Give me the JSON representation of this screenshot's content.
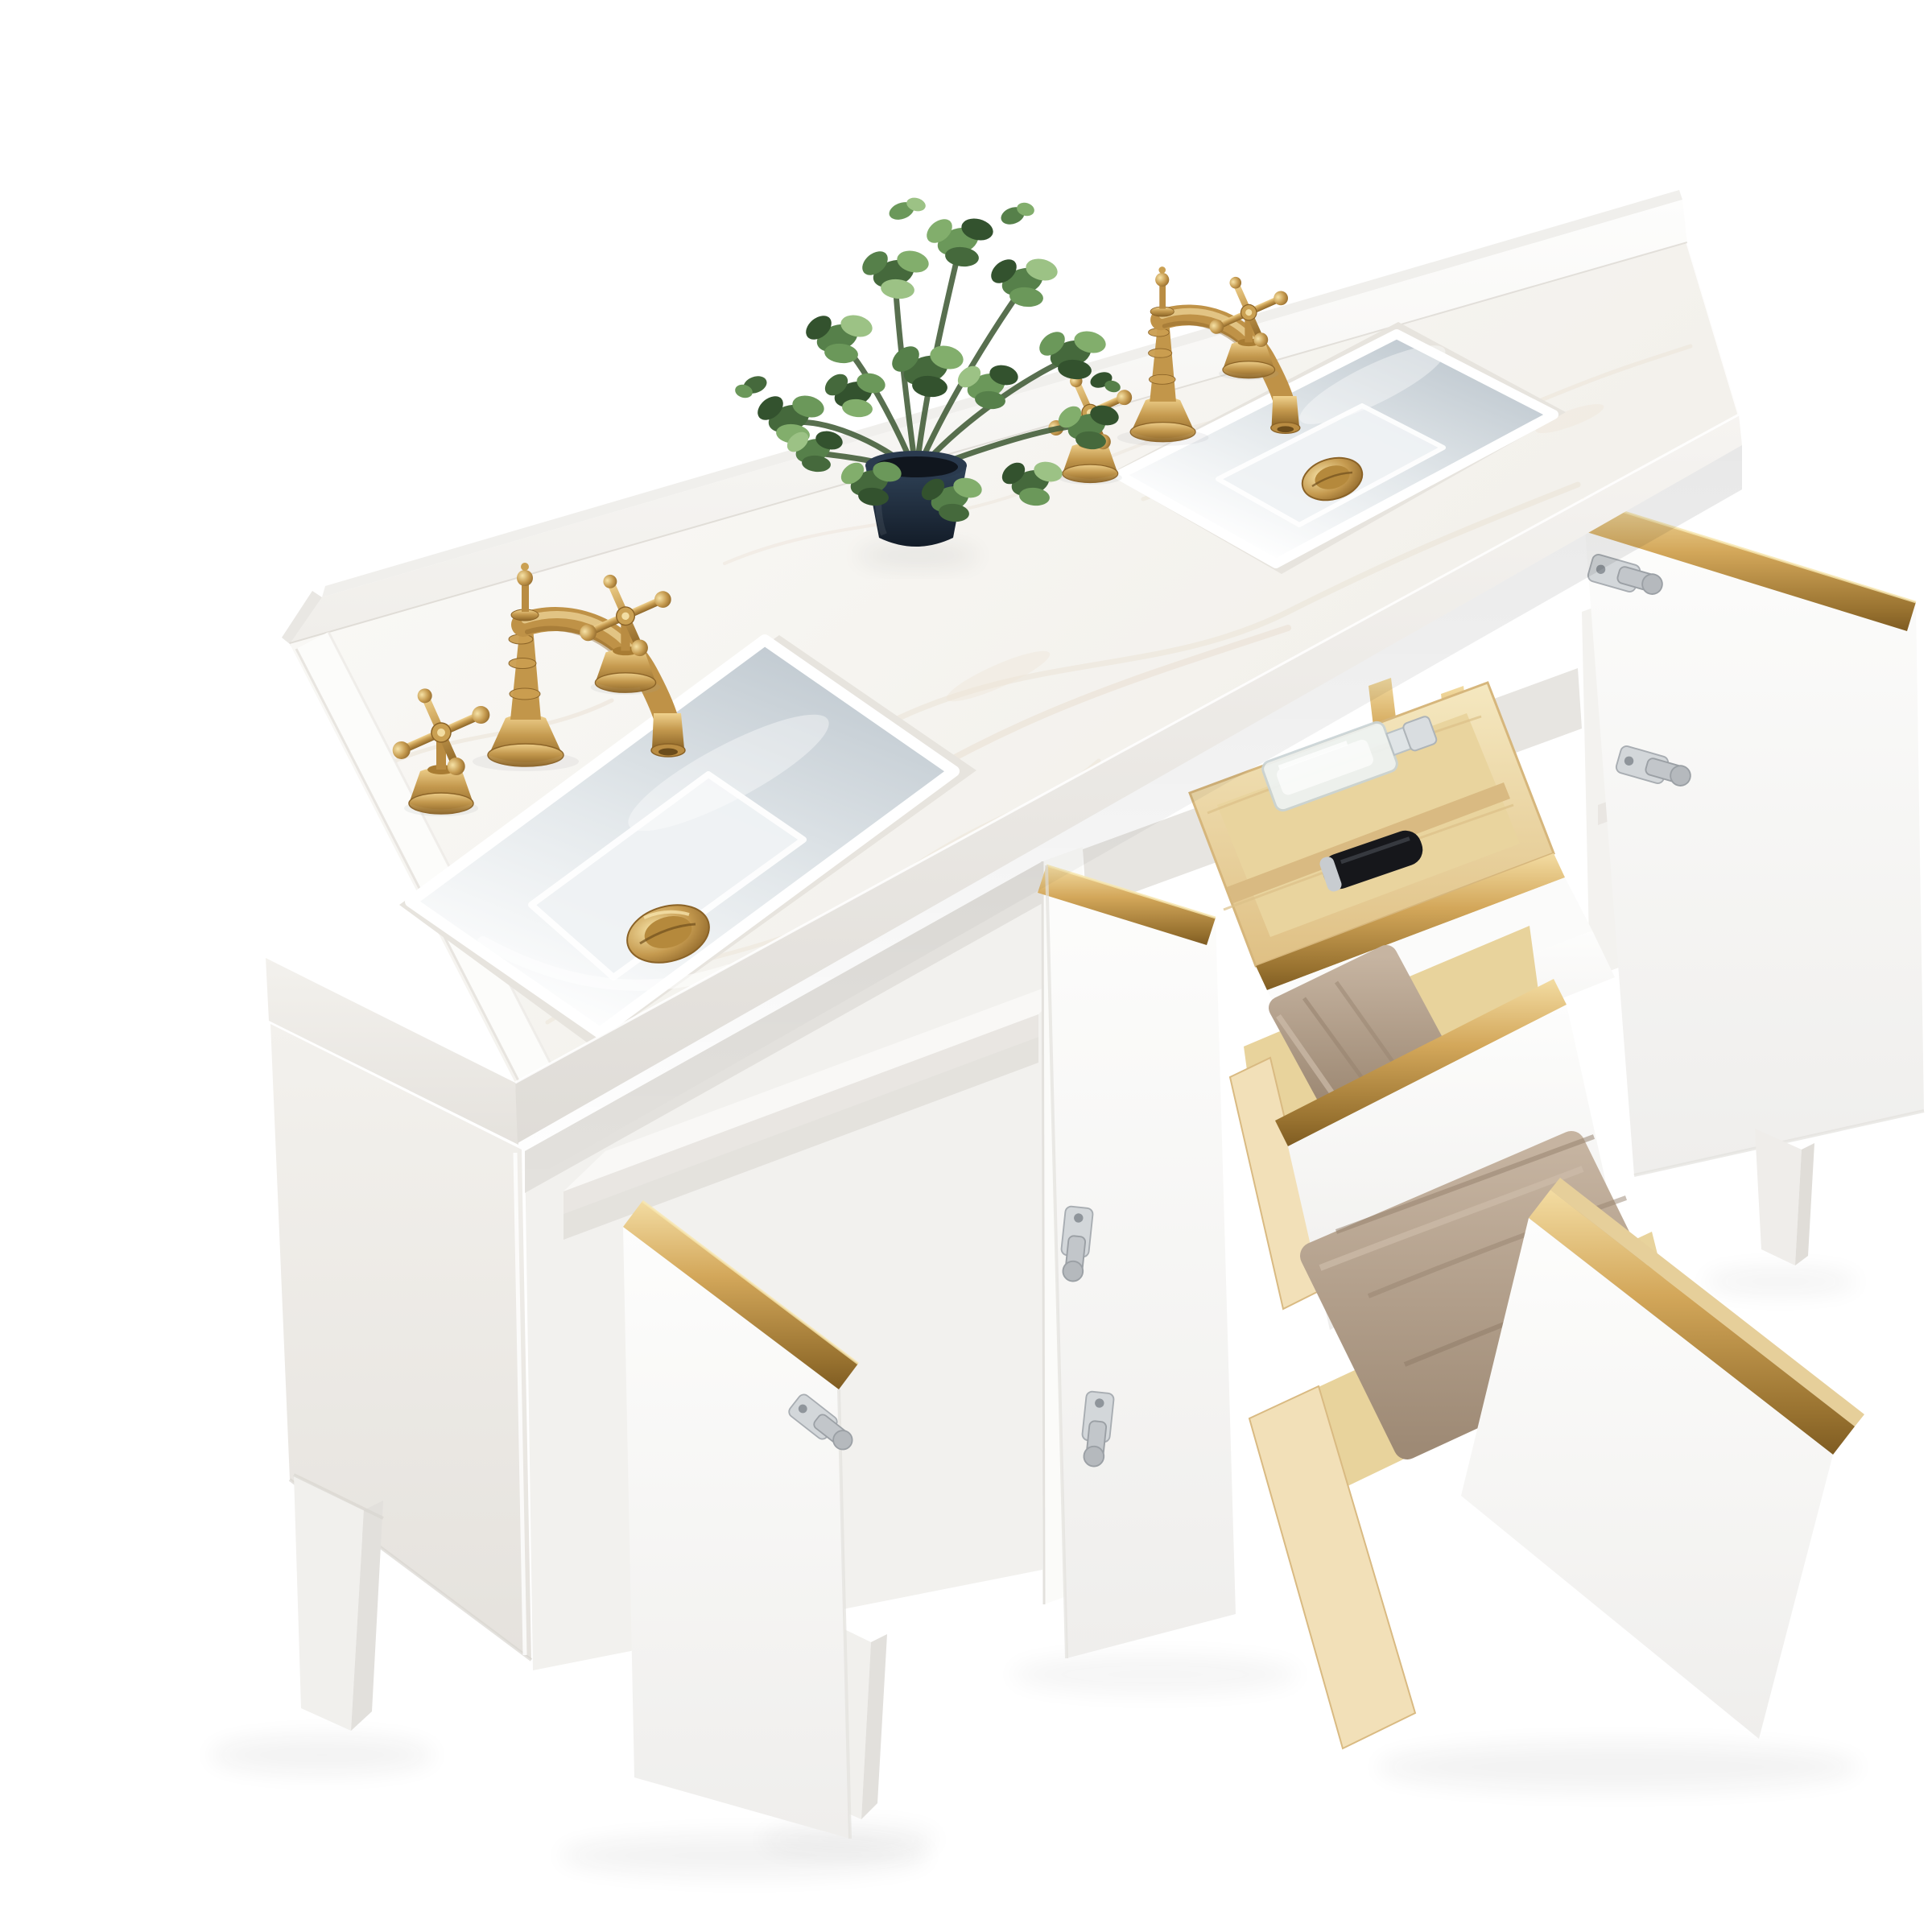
{
  "meta": {
    "description": "Product photo of a 60-inch white double-sink bathroom vanity viewed from above-front-left on a seamless white background, with brushed gold widespread faucets, white marble countertop and backsplash, three open doors and three open drawers with brushed gold edge trim, pine drawer boxes, folded tan towels, a glass perfume bottle, a black cosmetic bottle and an artificial green plant in a dark navy pot",
    "background_color": "#ffffff",
    "image_kind": "furniture-product-photo"
  },
  "palette": {
    "cabinet_white": "#fcfcfb",
    "cabinet_shadow": "#ececea",
    "marble_base": "#f7f6f3",
    "marble_vein": "#e9dfd1",
    "brass_gold": "#bd9146",
    "brass_highlight": "#f0d28e",
    "brass_shadow": "#8a6226",
    "pine_wood": "#efddae",
    "pine_shadow": "#d9ba82",
    "towel_tan": "#b3a08c",
    "towel_shadow": "#9a8672",
    "sink_shadow_blue": "#c6cfd6",
    "plant_green_dark": "#33522e",
    "plant_green_light": "#9cc285",
    "pot_navy": "#1c2836",
    "hinge_nickel": "#c9cdd1"
  },
  "scene": {
    "countertop": {
      "material": "white engineered marble with soft beige veining",
      "backsplash": true,
      "left_side_splash": true,
      "sinks": "two rectangular undermount ceramic sinks",
      "drains": "two brushed gold pop-up drains"
    },
    "fixtures": {
      "faucets": "two brushed gold 8-inch widespread faucets",
      "handle_style": "victorian cross handles",
      "spout_style": "curved column spout with finial"
    },
    "decor": {
      "plant": "artificial eucalyptus bush",
      "planter": "dark navy tapered pot"
    },
    "cabinet": {
      "finish": "matte white",
      "trim": "brushed gold edge pulls on doors and drawers",
      "open_doors": 3,
      "open_drawers": 3,
      "tilt_out_top_drawer": true,
      "drawer_boxes": "natural pine",
      "contents": [
        "glass perfume bottle",
        "black cosmetic bottle",
        "folded tan towel in middle drawer",
        "folded tan towel in bottom drawer"
      ],
      "hardware": "nickel soft-close concealed hinges",
      "interior_shelf": true,
      "feet": "tapered white wood legs"
    }
  }
}
